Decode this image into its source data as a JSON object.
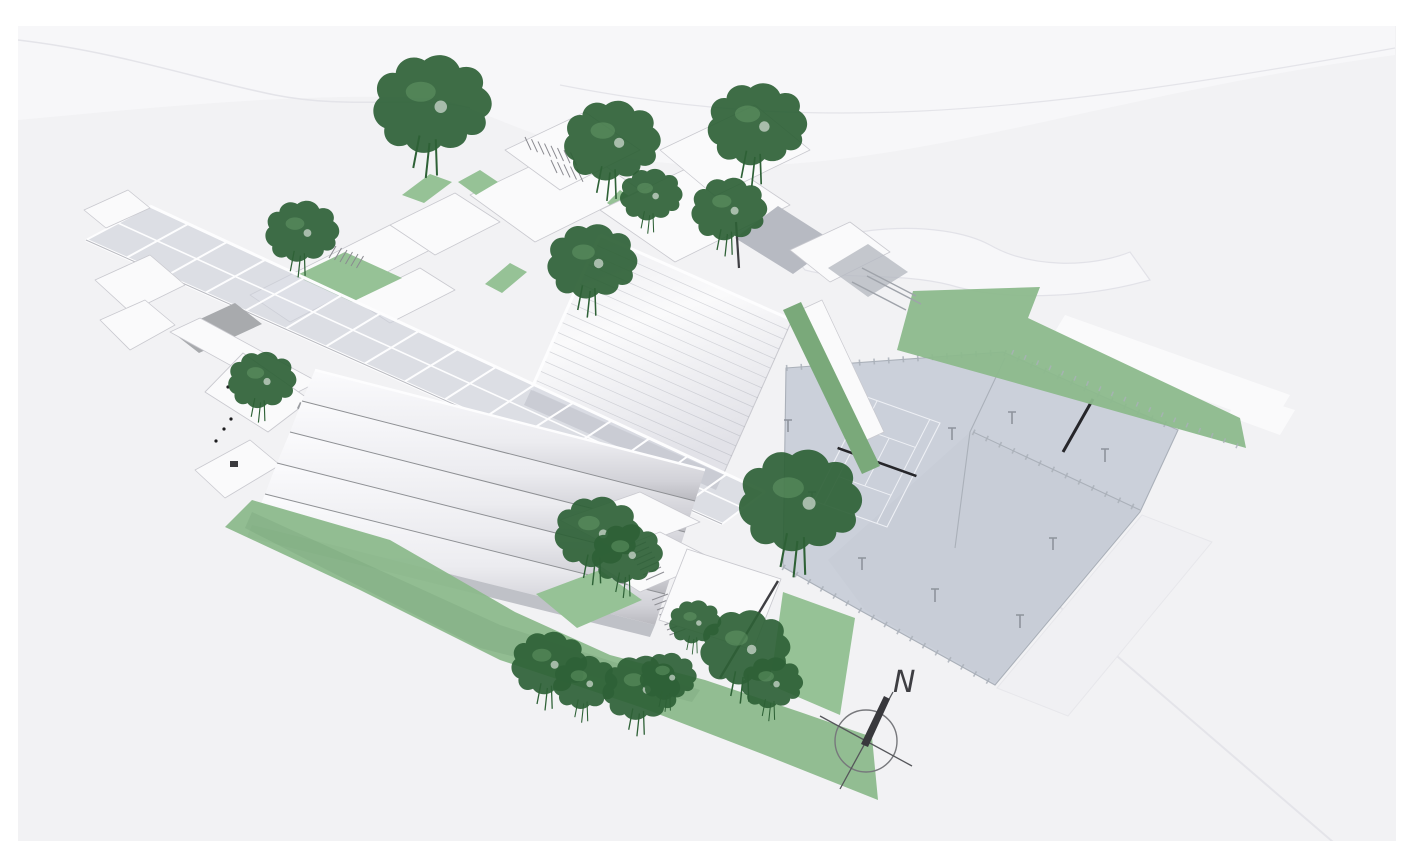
{
  "compass": {
    "label": "N"
  },
  "colors": {
    "terrain": "#f2f2f4",
    "plateau": "#f7f7f9",
    "frame": "#ffffff",
    "roof": "#fafafb",
    "roof_shade": "#e2e2e7",
    "wall": "#d6d6db",
    "wall_dark": "#bfc1c7",
    "gray_roof": "#a8aaad",
    "gray_court": "#b7bac2",
    "glass": "#cfd3db",
    "spine_frame": "#fdfdfe",
    "court": "#c8cdd7",
    "court_upper": "#cbd0da",
    "court_line": "#eef0f5",
    "net": "#26262a",
    "lawn": "#8cb98c",
    "lawn_dark": "#7aa97a",
    "courtyard_green": "#96c296",
    "tree": "#2e6136",
    "tree_light": "#6aa06c",
    "fence": "#aab0b9",
    "outline": "#c9c9cf",
    "terrain_line": "#e4e4e9",
    "ink": "#3e3e42"
  }
}
